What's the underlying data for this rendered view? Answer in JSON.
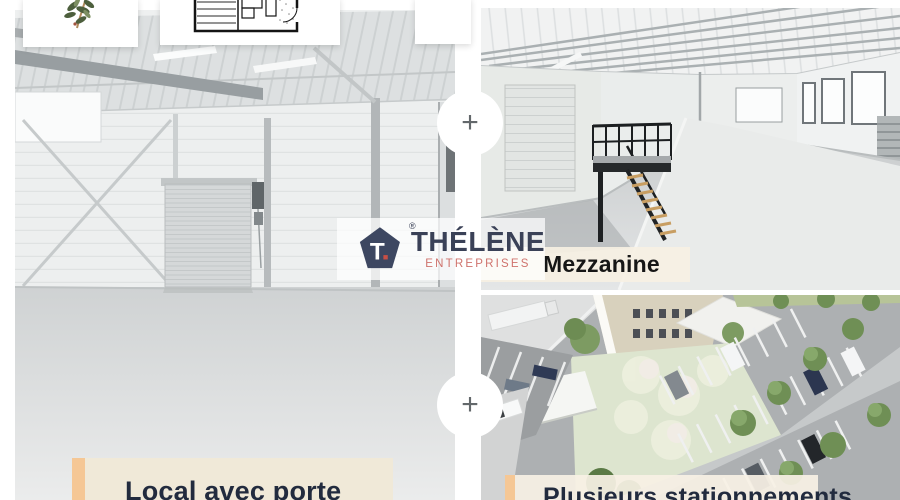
{
  "logo": {
    "brand": "THÉLÈNE",
    "subtitle": "ENTREPRISES",
    "monogram": "T",
    "registered": "®",
    "pentagon_color": "#3d4761",
    "brand_color": "#3a4157",
    "subtitle_color": "#cf736d",
    "monogram_dot_color": "#c94f45"
  },
  "gallery": {
    "photos": [
      {
        "id": "warehouse-interior",
        "caption": "Local avec porte"
      },
      {
        "id": "mezzanine-hall",
        "caption": "Mezzanine"
      },
      {
        "id": "parking-aerial",
        "caption": "Plusieurs stationnements"
      }
    ],
    "dividers": [
      {
        "label": "+"
      },
      {
        "label": "+"
      }
    ],
    "thumbnails": [
      {
        "id": "plant-card"
      },
      {
        "id": "floorplan-card"
      },
      {
        "id": "partial-card"
      }
    ]
  },
  "colors": {
    "page_background": "#ffffff",
    "caption_band": "#f3ecdb",
    "caption_card": "#f0e9d8",
    "accent_peach": "#f5c795",
    "caption_text": "#222b3e",
    "mezzanine_text": "#161616"
  }
}
